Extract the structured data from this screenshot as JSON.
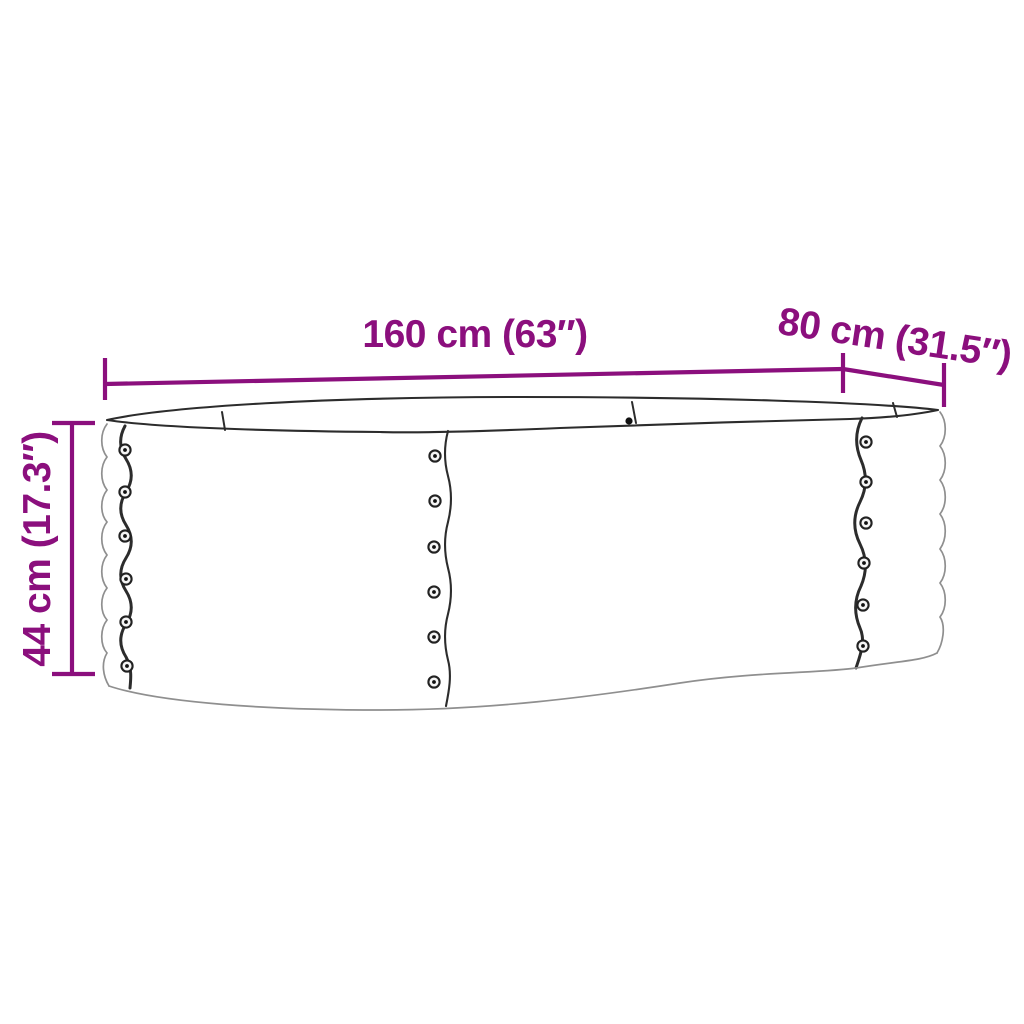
{
  "figure": {
    "kind": "product-dimension-diagram",
    "subject": "oval corrugated metal raised garden bed, open top, riveted seams",
    "background": "#ffffff",
    "colors": {
      "dimension": "#8b0f7d",
      "outline_dark": "#2c2c2c",
      "outline_light": "#8f8f8f"
    },
    "dimensions": [
      {
        "id": "length",
        "label": "160 cm (63″)",
        "value_cm": 160,
        "value_inch": 63,
        "orientation": "horizontal-top"
      },
      {
        "id": "width",
        "label": "80 cm (31.5″)",
        "value_cm": 80,
        "value_inch": 31.5,
        "orientation": "diagonal-top-right"
      },
      {
        "id": "height",
        "label": "44 cm (17.3″)",
        "value_cm": 44,
        "value_inch": 17.3,
        "orientation": "vertical-left"
      }
    ]
  }
}
